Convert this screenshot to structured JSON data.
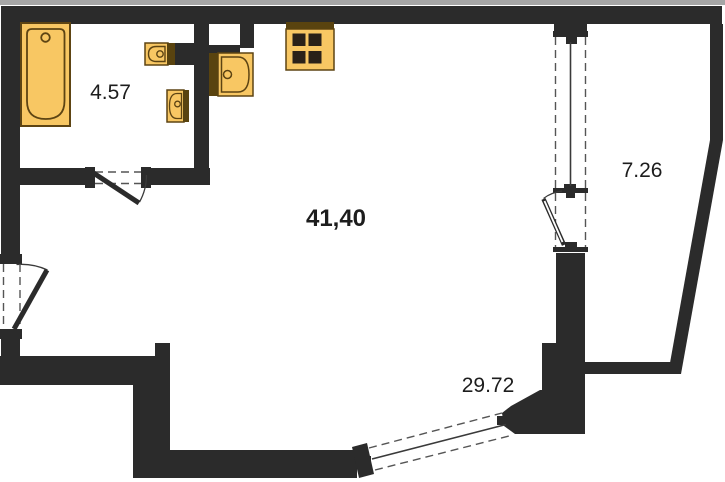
{
  "plan": {
    "type": "apartment-floor-plan",
    "rooms": {
      "bathroom": {
        "area": "4.57"
      },
      "main_room": {
        "area": "41,40"
      },
      "balcony": {
        "area": "7.26"
      },
      "lower_zone": {
        "area": "29.72"
      }
    },
    "fixtures": [
      "bathtub",
      "bath-sink",
      "toilet",
      "kitchen-sink",
      "stove-4-burner"
    ],
    "openings": [
      "bathroom-door",
      "entry-door",
      "balcony-door",
      "balcony-window",
      "bottom-angled-window"
    ]
  },
  "colors": {
    "wall": "#2b2b2b",
    "fixture_fill": "#f8c763",
    "fixture_stroke": "#5d4413",
    "fixture_dark": "#59430f",
    "burner": "#2a2118",
    "line": "#3a3a3a",
    "dash": "#555555",
    "text": "#1d1d1d",
    "top_edge": "#a6a6a6",
    "background": "#ffffff"
  }
}
